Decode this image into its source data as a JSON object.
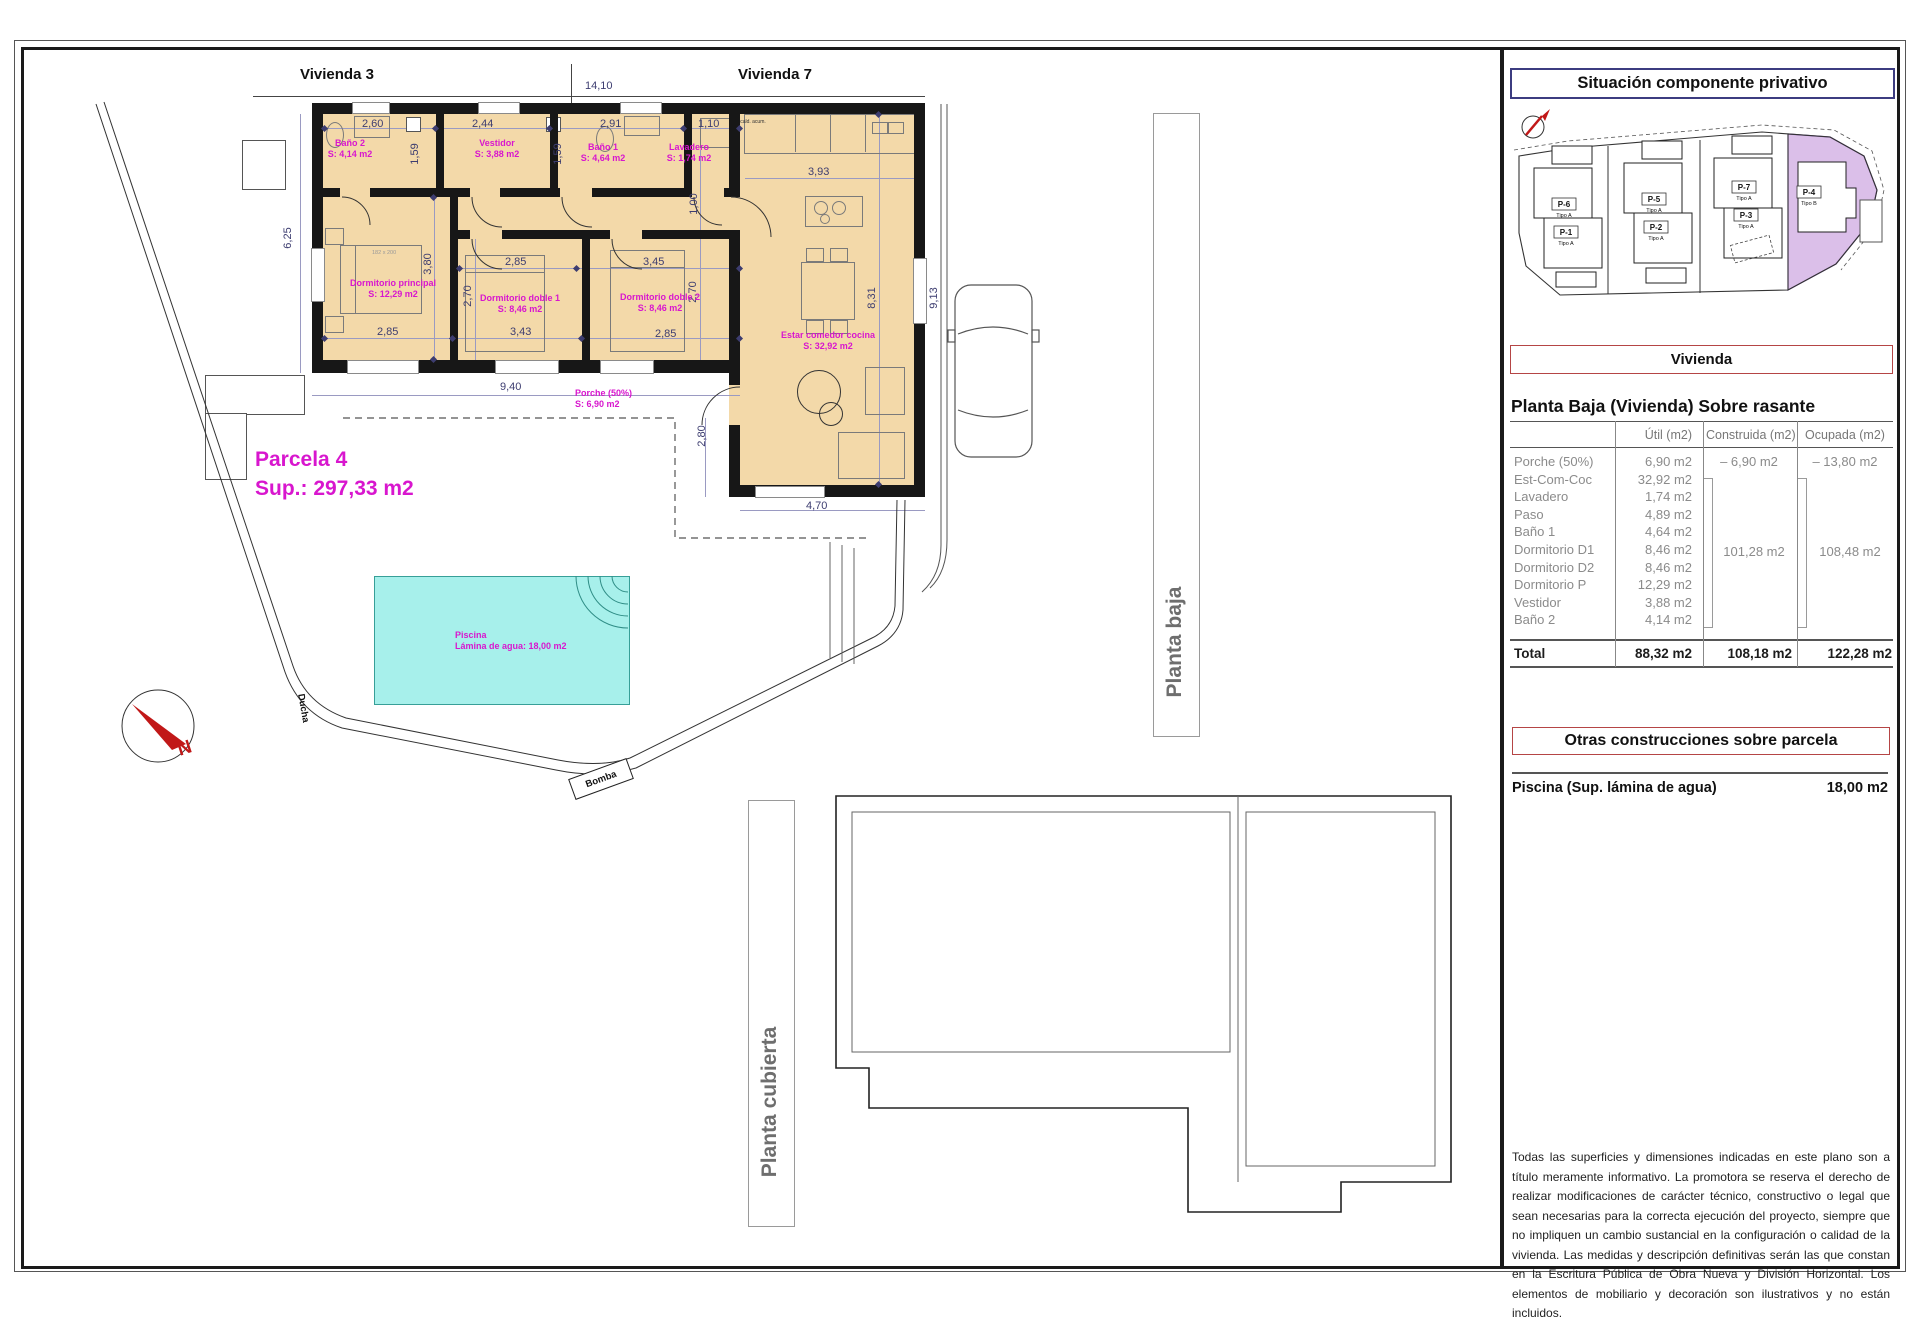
{
  "colors": {
    "room_fill": "#f3d9a9",
    "label_magenta": "#d816ce",
    "pool_fill": "#a7f0eb",
    "pool_border": "#379f98",
    "parcel_highlight": "#dbbfe9",
    "wall": "#171717",
    "dim_text": "#3d3d70",
    "red_box_border": "#b54545",
    "navy_box_border": "#3c3c80"
  },
  "plan": {
    "vivienda3": "Vivienda 3",
    "vivienda7": "Vivienda 7",
    "parcela": {
      "name": "Parcela 4",
      "sup": "Sup.: 297,33 m2"
    },
    "rooms": {
      "bano2": {
        "name": "Baño 2",
        "area": "S: 4,14 m2"
      },
      "vestidor": {
        "name": "Vestidor",
        "area": "S: 3,88 m2"
      },
      "bano1": {
        "name": "Baño 1",
        "area": "S: 4,64 m2"
      },
      "lavadero": {
        "name": "Lavadero",
        "area": "S: 1,74 m2"
      },
      "dormitorio_principal": {
        "name": "Dormitorio principal",
        "area": "S: 12,29 m2"
      },
      "dormitorio_doble1": {
        "name": "Dormitorio doble 1",
        "area": "S: 8,46 m2"
      },
      "dormitorio_doble2": {
        "name": "Dormitorio doble 2",
        "area": "S: 8,46 m2"
      },
      "estar": {
        "name": "Estar comedor cocina",
        "area": "S: 32,92 m2"
      },
      "porche": {
        "name": "Porche (50%)",
        "area": "S: 6,90 m2"
      }
    },
    "pool": {
      "name": "Piscina",
      "sub": "Lámina de agua: 18,00 m2"
    },
    "ducha": "Ducha",
    "bomba": "Bomba",
    "north": "N",
    "kitchen_note": "cald. acum.",
    "bed_note": "182 x 200",
    "dims": {
      "w_total": "14,10",
      "w_bano2": "2,60",
      "w_vestidor": "2,44",
      "w_bano1": "2,91",
      "w_lavadero": "1,10",
      "h_bano_a": "1,59",
      "h_bano_b": "1,59",
      "h_left": "6,25",
      "h_principal": "3,80",
      "w_doble1_t": "2,85",
      "w_doble2_t": "3,45",
      "h_doble1": "2,70",
      "h_doble2": "2,70",
      "w_principal_b": "2,85",
      "w_doble1_b": "3,43",
      "w_doble2_b": "2,85",
      "h_paso": "1,00",
      "w_cocina": "3,93",
      "h_estar": "8,31",
      "h_parcela_r": "9,13",
      "w_porche": "9,40",
      "h_porche": "2,80",
      "w_living_b": "4,70"
    }
  },
  "floors": {
    "planta_baja": "Planta baja",
    "planta_cubierta": "Planta cubierta"
  },
  "roof": {
    "panel": "Placa Fotovoltaica"
  },
  "sidebar": {
    "situacion_title": "Situación componente privativo",
    "map": {
      "parcels": [
        {
          "code": "P-6",
          "tipo": "Tipo A"
        },
        {
          "code": "P-1",
          "tipo": "Tipo A"
        },
        {
          "code": "P-5",
          "tipo": "Tipo A"
        },
        {
          "code": "P-2",
          "tipo": "Tipo A"
        },
        {
          "code": "P-7",
          "tipo": "Tipo A"
        },
        {
          "code": "P-3",
          "tipo": "Tipo A"
        },
        {
          "code": "P-4",
          "tipo": "Tipo B"
        }
      ]
    },
    "vivienda_title": "Vivienda",
    "section_title": "Planta Baja (Vivienda) Sobre rasante",
    "table": {
      "headers": {
        "util": "Útil (m2)",
        "construida": "Construida (m2)",
        "ocupada": "Ocupada (m2)"
      },
      "rows": [
        {
          "name": "Porche (50%)",
          "util": "6,90 m2",
          "construida": "–  6,90 m2",
          "ocupada": "–  13,80 m2"
        },
        {
          "name": "Est-Com-Coc",
          "util": "32,92 m2",
          "construida": "",
          "ocupada": ""
        },
        {
          "name": "Lavadero",
          "util": "1,74 m2",
          "construida": "",
          "ocupada": ""
        },
        {
          "name": "Paso",
          "util": "4,89 m2",
          "construida": "",
          "ocupada": ""
        },
        {
          "name": "Baño 1",
          "util": "4,64 m2",
          "construida": "",
          "ocupada": ""
        },
        {
          "name": "Dormitorio D1",
          "util": "8,46 m2",
          "construida": "",
          "ocupada": ""
        },
        {
          "name": "Dormitorio D2",
          "util": "8,46 m2",
          "construida": "",
          "ocupada": ""
        },
        {
          "name": "Dormitorio P",
          "util": "12,29 m2",
          "construida": "",
          "ocupada": ""
        },
        {
          "name": "Vestidor",
          "util": "3,88 m2",
          "construida": "",
          "ocupada": ""
        },
        {
          "name": "Baño 2",
          "util": "4,14 m2",
          "construida": "",
          "ocupada": ""
        }
      ],
      "construida_group": "101,28 m2",
      "ocupada_group": "108,48 m2",
      "total": {
        "name": "Total",
        "util": "88,32 m2",
        "construida": "108,18 m2",
        "ocupada": "122,28 m2"
      }
    },
    "otras_title": "Otras construcciones sobre parcela",
    "piscina": {
      "label": "Piscina (Sup. lámina de agua)",
      "value": "18,00 m2"
    },
    "disclaimer": "Todas las superficies y dimensiones indicadas en este plano son a título meramente informativo. La promotora se reserva el derecho de realizar modificaciones de carácter técnico, constructivo o legal que sean necesarias para la correcta ejecución del proyecto, siempre que no impliquen un cambio sustancial en la configuración o calidad de la vivienda. Las medidas y descripción definitivas serán las que constan en la Escritura Pública de Obra Nueva y División Horizontal. Los elementos de mobiliario y decoración son ilustrativos y no están incluidos."
  }
}
